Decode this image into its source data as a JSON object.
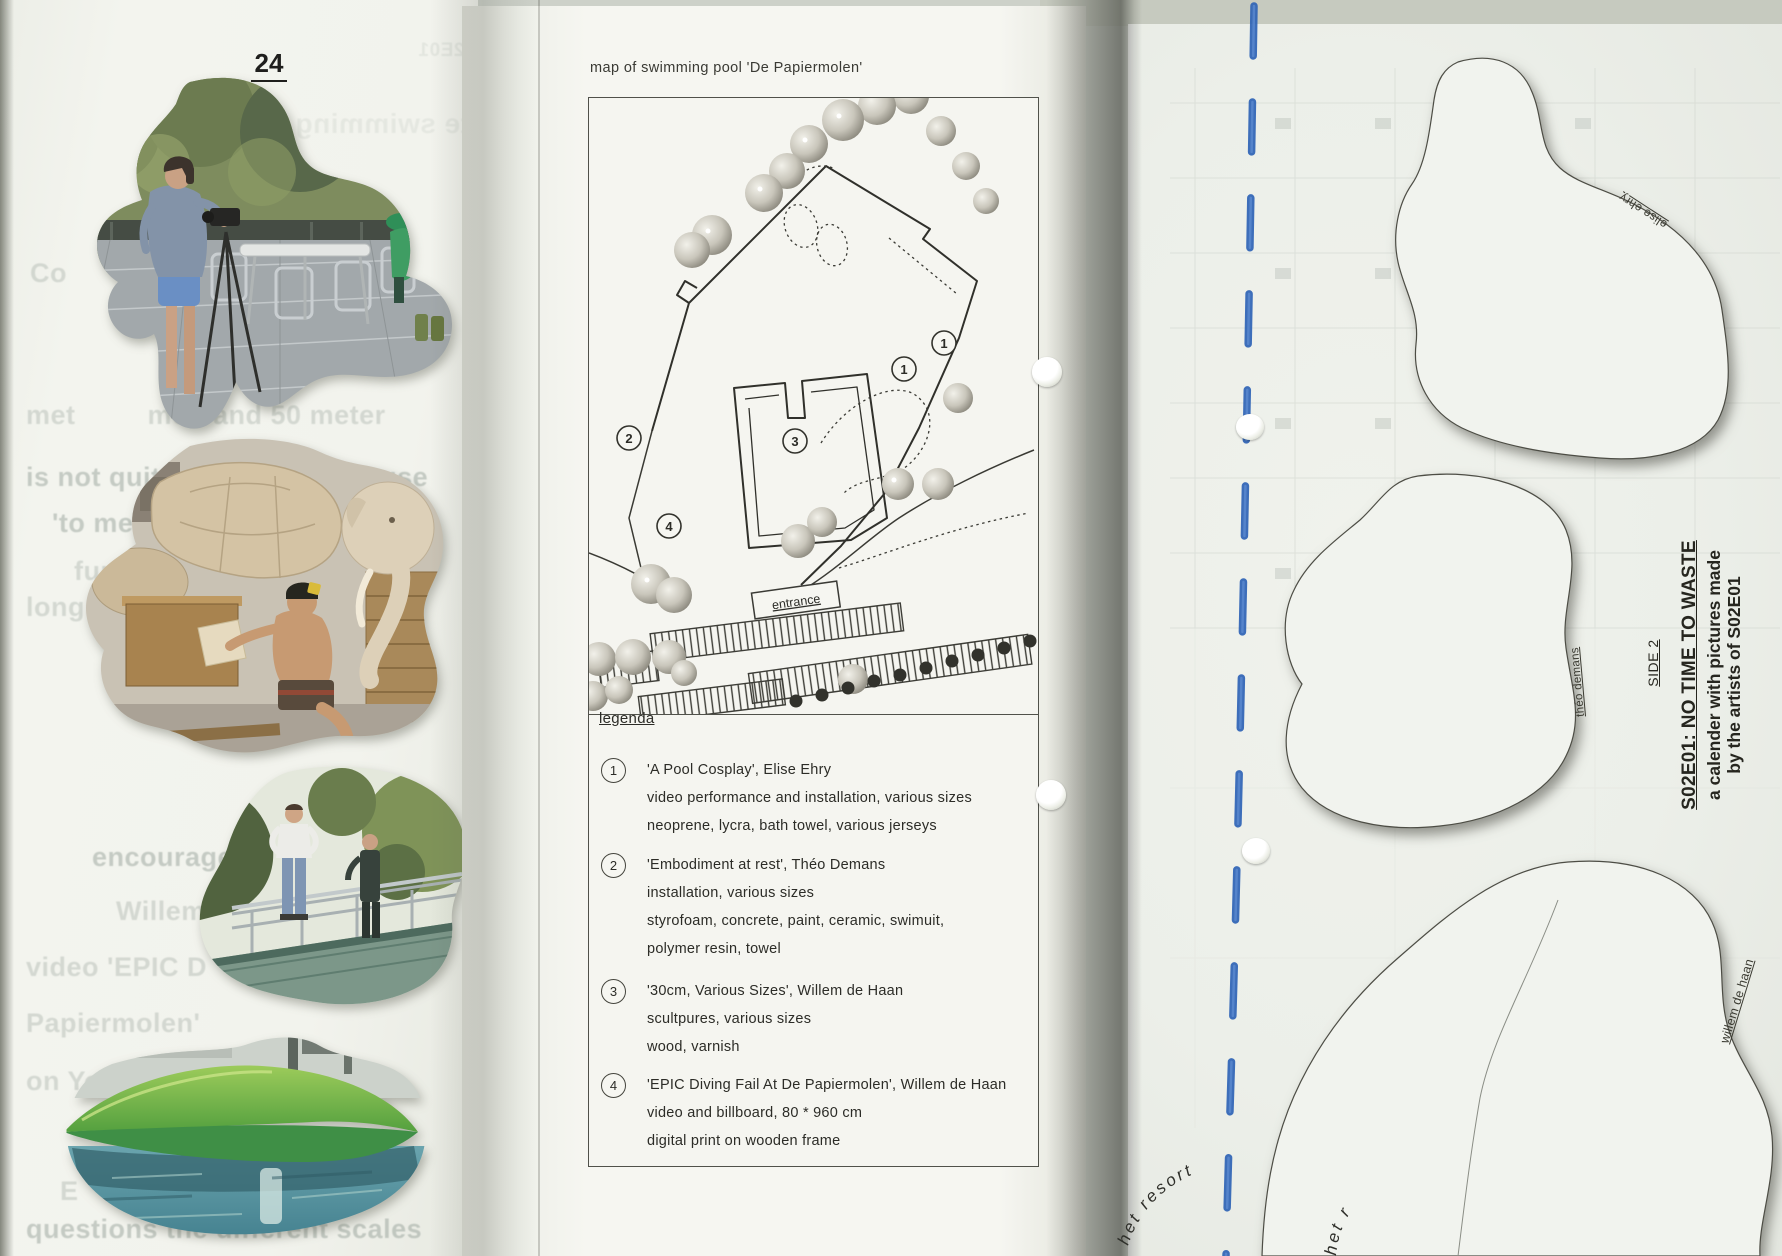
{
  "page_left": {
    "page_number": "24",
    "ghost_lines": [
      "Co",
      "met         mo   and 50 meter",
      "is not quite 50 meter. Because",
      "'to measure is to know' is",
      "fun",
      "long",
      "encourage the daredevils",
      "Willem has           a",
      "video 'EPIC D           De",
      "Papiermolen'",
      "on YouTube befo",
      "E",
      "questions the different scales"
    ],
    "ghost_mirrored": [
      "elite swimming",
      "S02E01"
    ]
  },
  "page_center": {
    "map_title": "map of swimming pool 'De Papiermolen'",
    "legend_heading": "legenda",
    "map_labels": {
      "entrance": "entrance",
      "markers": [
        "1",
        "1",
        "2",
        "3",
        "4"
      ]
    },
    "legend_items": [
      {
        "number": "1",
        "title": "'A Pool Cosplay', Elise Ehry",
        "lines": [
          "video performance and installation, various sizes",
          "neoprene, lycra, bath towel, various jerseys"
        ]
      },
      {
        "number": "2",
        "title": "'Embodiment at rest', Théo Demans",
        "lines": [
          "installation, various sizes",
          "styrofoam, concrete, paint, ceramic, swimuit,",
          "polymer resin, towel"
        ]
      },
      {
        "number": "3",
        "title": "'30cm, Various Sizes', Willem de Haan",
        "lines": [
          "scultpures, various sizes",
          "wood, varnish"
        ]
      },
      {
        "number": "4",
        "title": "'EPIC Diving Fail At De Papiermolen', Willem de Haan",
        "lines": [
          "video and billboard, 80 * 960 cm",
          "digital print on wooden frame"
        ]
      }
    ]
  },
  "page_right": {
    "side_label": "SIDE 2",
    "title": "S02E01: NO TIME TO WASTE",
    "subtitle_line1": "a calender with pictures made",
    "subtitle_line2": "by the artists of S02E01",
    "shape_labels": {
      "elise": "elise ehry",
      "theo": "théo demans",
      "willem": "willem de haan"
    },
    "resort_labels": [
      "het resort",
      "het r"
    ]
  },
  "colors": {
    "binding_blue": "#2e63b5",
    "ink": "#2c2c27",
    "paper_center": "#f6f6f1",
    "paper_right": "#ecefe9",
    "ghost_text": "#8e9a92"
  }
}
